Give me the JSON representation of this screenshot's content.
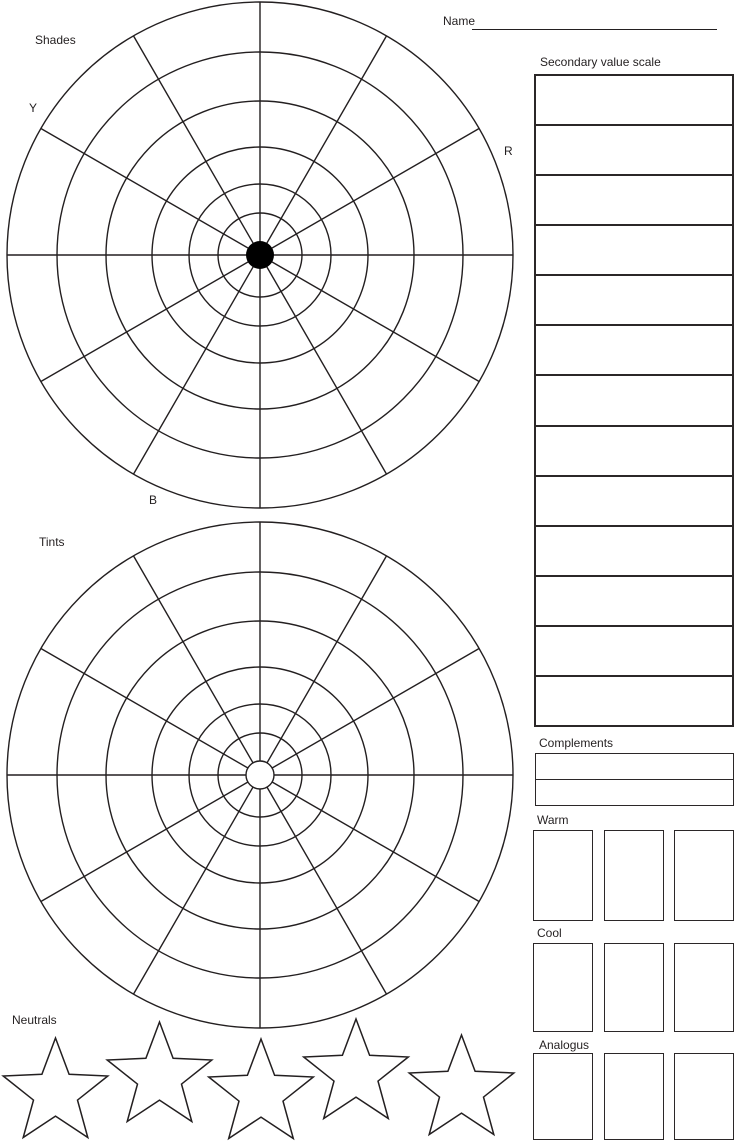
{
  "colors": {
    "line": "#231f20",
    "text": "#231f20",
    "background": "#ffffff",
    "shades_center": "#000000"
  },
  "header": {
    "name_label": "Name"
  },
  "shades_wheel": {
    "label": "Shades",
    "hue_labels": [
      "Y",
      "R",
      "B"
    ],
    "rings": 6,
    "spokes": 12,
    "center_style": "filled"
  },
  "tints_wheel": {
    "label": "Tints",
    "rings": 6,
    "spokes": 12,
    "center_style": "open"
  },
  "secondary_value_scale": {
    "label": "Secondary value scale",
    "cell_count": 13
  },
  "complements": {
    "label": "Complements",
    "row_count": 2
  },
  "warm": {
    "label": "Warm",
    "box_count": 3
  },
  "cool": {
    "label": "Cool",
    "box_count": 3
  },
  "analogous": {
    "label": "Analogus",
    "box_count": 3
  },
  "neutrals": {
    "label": "Neutrals",
    "star_count": 5
  }
}
